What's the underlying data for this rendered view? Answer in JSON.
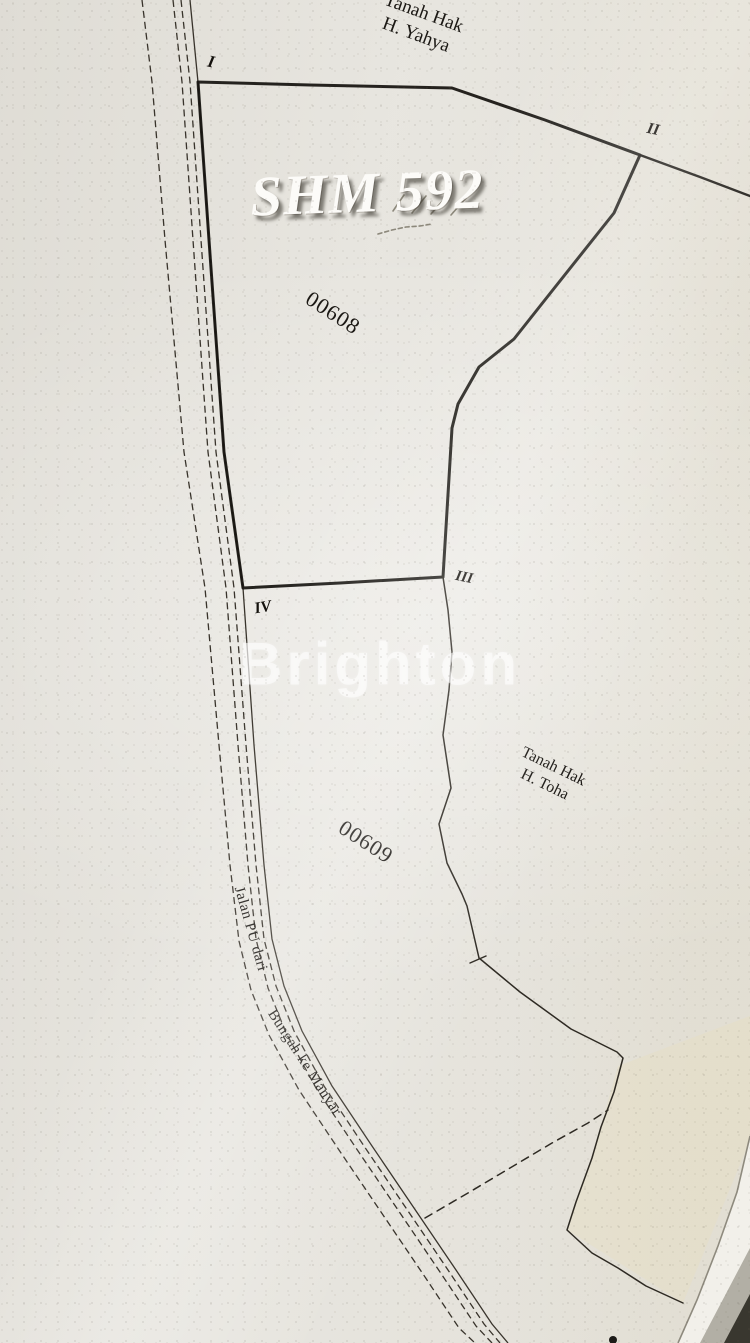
{
  "labels": {
    "overlay_title": "SHM 592",
    "watermark": "Brighton",
    "parcel_1": "00608",
    "parcel_2": "00609",
    "neighbor_top": {
      "line1": "Tanah Hak",
      "line2": "H. Yahya"
    },
    "neighbor_right": {
      "line1": "Tanah Hak",
      "line2": "H. Toha"
    },
    "road": {
      "part1": "Jalan PU dari",
      "part2": "Bungah ke Manyar"
    },
    "markers": {
      "i": "I",
      "ii": "II",
      "iii": "III",
      "iv": "IV"
    }
  },
  "colors": {
    "paper": "#e6e4de",
    "ink": "#16130f",
    "overlay_text": "#fcfbf8",
    "watermark": "rgba(255,255,255,0.55)",
    "page_edge_strip": "#f2f0ea",
    "page_corner_shadow": "#39372f"
  },
  "geometry": {
    "viewbox": [
      0,
      0,
      750,
      1343
    ],
    "shapes": [
      {
        "name": "neighbor-area-cream-tint",
        "type": "polygon",
        "cls": "fill-cream",
        "points": [
          [
            618,
            1066
          ],
          [
            750,
            1016
          ],
          [
            750,
            1140
          ],
          [
            683,
            1303
          ],
          [
            567,
            1230
          ],
          [
            592,
            1158
          ]
        ]
      },
      {
        "name": "road-line-outer-west",
        "type": "polyline",
        "cls": "thin dashed",
        "points": [
          [
            142,
            0
          ],
          [
            152,
            82
          ],
          [
            165,
            240
          ],
          [
            184,
            452
          ],
          [
            205,
            588
          ],
          [
            219,
            745
          ],
          [
            230,
            865
          ],
          [
            239,
            941
          ],
          [
            251,
            990
          ],
          [
            269,
            1035
          ],
          [
            299,
            1090
          ],
          [
            339,
            1150
          ],
          [
            381,
            1212
          ],
          [
            423,
            1274
          ],
          [
            459,
            1328
          ],
          [
            475,
            1343
          ]
        ]
      },
      {
        "name": "road-line-inner-west",
        "type": "polyline",
        "cls": "thin dashed",
        "points": [
          [
            173,
            0
          ],
          [
            182,
            82
          ],
          [
            193,
            240
          ],
          [
            208,
            452
          ],
          [
            226,
            588
          ],
          [
            238,
            745
          ],
          [
            248,
            865
          ],
          [
            256,
            939
          ],
          [
            268,
            988
          ],
          [
            286,
            1033
          ],
          [
            316,
            1088
          ],
          [
            356,
            1148
          ],
          [
            398,
            1210
          ],
          [
            440,
            1272
          ],
          [
            476,
            1326
          ],
          [
            492,
            1343
          ]
        ]
      },
      {
        "name": "road-line-inner-east",
        "type": "polyline",
        "cls": "thin dashed",
        "points": [
          [
            181,
            0
          ],
          [
            190,
            82
          ],
          [
            201,
            240
          ],
          [
            216,
            452
          ],
          [
            234,
            588
          ],
          [
            246,
            745
          ],
          [
            256,
            865
          ],
          [
            264,
            939
          ],
          [
            276,
            986
          ],
          [
            294,
            1031
          ],
          [
            324,
            1086
          ],
          [
            364,
            1146
          ],
          [
            406,
            1208
          ],
          [
            448,
            1270
          ],
          [
            484,
            1324
          ],
          [
            500,
            1343
          ]
        ]
      },
      {
        "name": "road-line-outer-east",
        "type": "polyline",
        "cls": "thin",
        "points": [
          [
            190,
            0
          ],
          [
            198,
            82
          ],
          [
            209,
            240
          ],
          [
            224,
            452
          ],
          [
            243,
            588
          ],
          [
            254,
            745
          ],
          [
            264,
            865
          ],
          [
            272,
            939
          ],
          [
            284,
            986
          ],
          [
            302,
            1031
          ],
          [
            332,
            1086
          ],
          [
            372,
            1146
          ],
          [
            414,
            1208
          ],
          [
            456,
            1270
          ],
          [
            492,
            1324
          ],
          [
            508,
            1343
          ]
        ]
      },
      {
        "name": "parcel-00608-boundary",
        "type": "polygon",
        "cls": "heavy",
        "points": [
          [
            198,
            82
          ],
          [
            310,
            85
          ],
          [
            452,
            88
          ],
          [
            545,
            120
          ],
          [
            640,
            155
          ],
          [
            614,
            213
          ],
          [
            552,
            291
          ],
          [
            514,
            339
          ],
          [
            479,
            367
          ],
          [
            458,
            404
          ],
          [
            452,
            428
          ],
          [
            449,
            478
          ],
          [
            443,
            577
          ],
          [
            340,
            583
          ],
          [
            243,
            588
          ],
          [
            224,
            452
          ],
          [
            209,
            240
          ]
        ]
      },
      {
        "name": "boundary-east-of-ii",
        "type": "polyline",
        "cls": "med",
        "points": [
          [
            640,
            155
          ],
          [
            700,
            177
          ],
          [
            750,
            196
          ]
        ]
      },
      {
        "name": "boundary-toha-west",
        "type": "polyline",
        "cls": "thin2",
        "points": [
          [
            443,
            577
          ],
          [
            448,
            610
          ],
          [
            452,
            652
          ],
          [
            449,
            690
          ],
          [
            443,
            735
          ],
          [
            451,
            788
          ],
          [
            439,
            824
          ],
          [
            447,
            863
          ],
          [
            462,
            894
          ],
          [
            467,
            906
          ],
          [
            479,
            958
          ],
          [
            520,
            992
          ],
          [
            571,
            1029
          ],
          [
            617,
            1052
          ],
          [
            623,
            1058
          ],
          [
            614,
            1092
          ],
          [
            601,
            1127
          ],
          [
            592,
            1158
          ],
          [
            576,
            1202
          ],
          [
            567,
            1230
          ],
          [
            592,
            1253
          ],
          [
            618,
            1268
          ],
          [
            646,
            1286
          ],
          [
            683,
            1303
          ]
        ]
      },
      {
        "name": "boundary-survey-tick",
        "type": "polyline",
        "cls": "thin2",
        "points": [
          [
            470,
            963
          ],
          [
            486,
            956
          ]
        ]
      },
      {
        "name": "boundary-dashed-southwest",
        "type": "polyline",
        "cls": "thin2 dashed2",
        "points": [
          [
            425,
            1218
          ],
          [
            468,
            1193
          ],
          [
            510,
            1168
          ],
          [
            552,
            1143
          ],
          [
            588,
            1123
          ],
          [
            608,
            1110
          ]
        ]
      },
      {
        "name": "pencil-mark-1",
        "type": "polyline",
        "cls": "pencil",
        "points": [
          [
            393,
            211
          ],
          [
            404,
            195
          ]
        ]
      },
      {
        "name": "pencil-mark-2",
        "type": "polyline",
        "cls": "pencil",
        "points": [
          [
            412,
            213
          ],
          [
            426,
            196
          ]
        ]
      },
      {
        "name": "pencil-mark-3",
        "type": "polyline",
        "cls": "pencil",
        "points": [
          [
            431,
            214
          ],
          [
            446,
            197
          ]
        ]
      },
      {
        "name": "pencil-mark-4",
        "type": "polyline",
        "cls": "pencil",
        "points": [
          [
            451,
            215
          ],
          [
            466,
            198
          ]
        ]
      },
      {
        "name": "pencil-underline",
        "type": "polyline",
        "cls": "pencil pencil-dash",
        "points": [
          [
            378,
            234
          ],
          [
            392,
            230
          ],
          [
            406,
            227
          ],
          [
            420,
            226
          ],
          [
            432,
            224
          ]
        ]
      },
      {
        "name": "ink-blot",
        "type": "circle",
        "cx": 613,
        "cy": 1340,
        "r": 4,
        "cls": "blot"
      },
      {
        "name": "page-edge-strip",
        "type": "polygon",
        "cls": "fill-strip",
        "points": [
          [
            750,
            1136
          ],
          [
            737,
            1192
          ],
          [
            718,
            1246
          ],
          [
            697,
            1300
          ],
          [
            678,
            1343
          ],
          [
            750,
            1343
          ]
        ]
      },
      {
        "name": "page-edge-line",
        "type": "polyline",
        "cls": "edge-line",
        "points": [
          [
            750,
            1136
          ],
          [
            737,
            1192
          ],
          [
            718,
            1246
          ],
          [
            697,
            1300
          ],
          [
            678,
            1343
          ]
        ]
      },
      {
        "name": "page-corner-mid",
        "type": "polygon",
        "cls": "fill-mid",
        "points": [
          [
            750,
            1248
          ],
          [
            750,
            1343
          ],
          [
            700,
            1343
          ]
        ]
      },
      {
        "name": "page-corner-dark",
        "type": "polygon",
        "cls": "fill-dark",
        "points": [
          [
            750,
            1294
          ],
          [
            750,
            1343
          ],
          [
            724,
            1343
          ]
        ]
      }
    ]
  }
}
